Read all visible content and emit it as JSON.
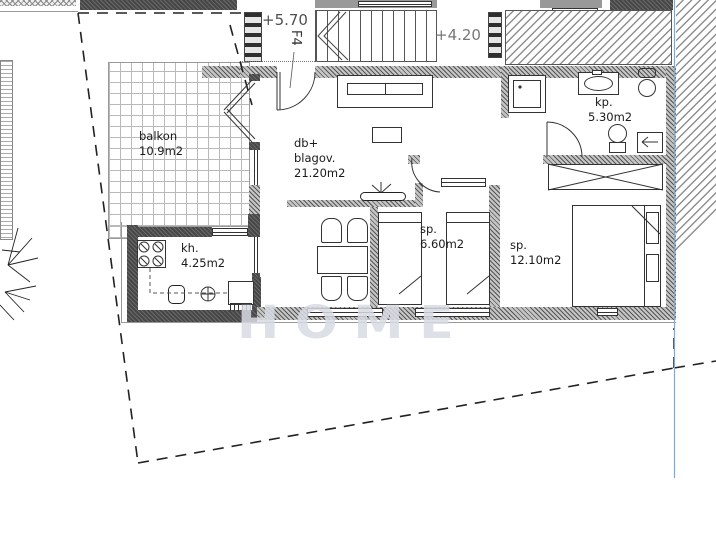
{
  "plan": {
    "unit_label": "F4",
    "elevation_upper": "+5.70",
    "elevation_lower": "+4.20",
    "watermark": "HOME",
    "rooms": {
      "balkon": {
        "name": "balkon",
        "area": "10.9m2"
      },
      "kitchen": {
        "name": "kh.",
        "area": "4.25m2"
      },
      "living": {
        "line1": "db+",
        "line2": "blagov.",
        "area": "21.20m2"
      },
      "bedroom_small": {
        "name": "sp.",
        "area": "6.60m2"
      },
      "bedroom_large": {
        "name": "sp.",
        "area": "12.10m2"
      },
      "bathroom": {
        "name": "kp.",
        "area": "5.30m2"
      }
    },
    "colors": {
      "wall_hatch": "#b5b5b5",
      "dark_wall": "#474747",
      "line": "#1a1a1a",
      "parcel_dash": "#222222",
      "blue_line": "#8ba6c2",
      "watermark_gray": "#d7dbe2"
    }
  }
}
